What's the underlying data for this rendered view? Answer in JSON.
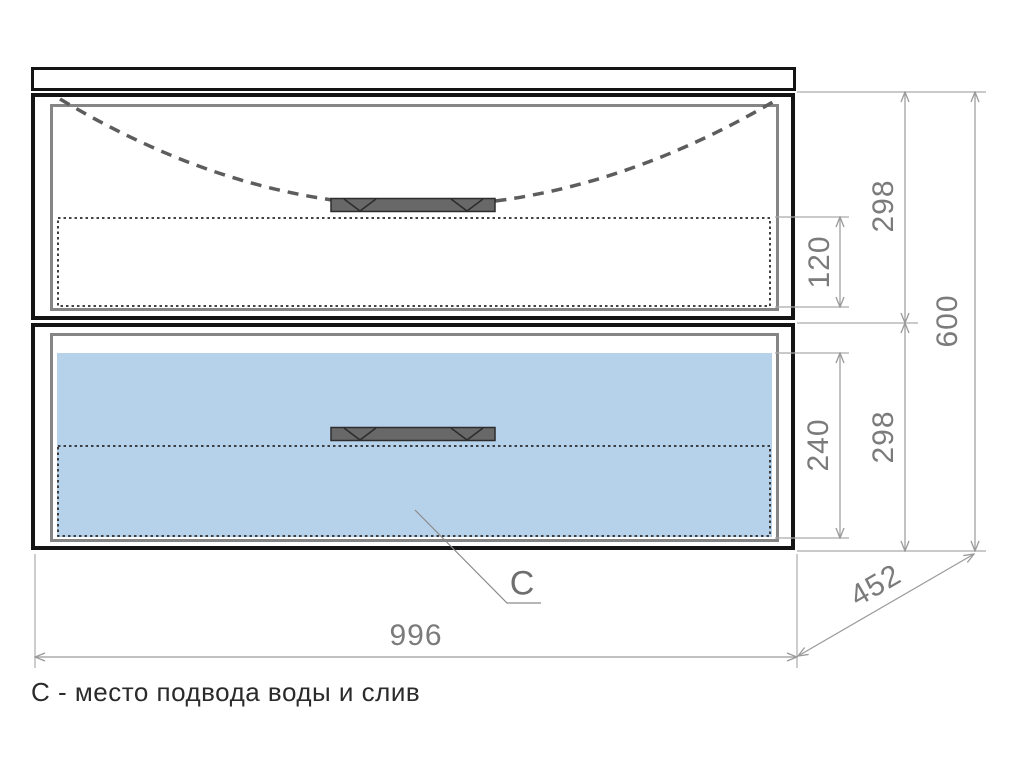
{
  "caption": "С - место подвода воды и слив",
  "leader": {
    "label": "C"
  },
  "dimensions": {
    "overall_width": "996",
    "overall_height": "600",
    "depth": "452",
    "top_drawer_height": "298",
    "bottom_drawer_height": "298",
    "top_drawer_internal_height": "120",
    "bottom_drawer_internal_height": "240"
  },
  "colors": {
    "outline": "#141414",
    "inner_frame": "#858585",
    "dimension_line": "#9a9a9a",
    "dimension_text": "#7b7b7b",
    "plumbing_zone_fill": "#b6d1ea",
    "handle_fill": "#686868",
    "hidden_sink_line": "#5d5d5d",
    "dotted_internal_line": "#2a2a2a",
    "caption_text": "#2b2b2b",
    "background": "#ffffff"
  }
}
